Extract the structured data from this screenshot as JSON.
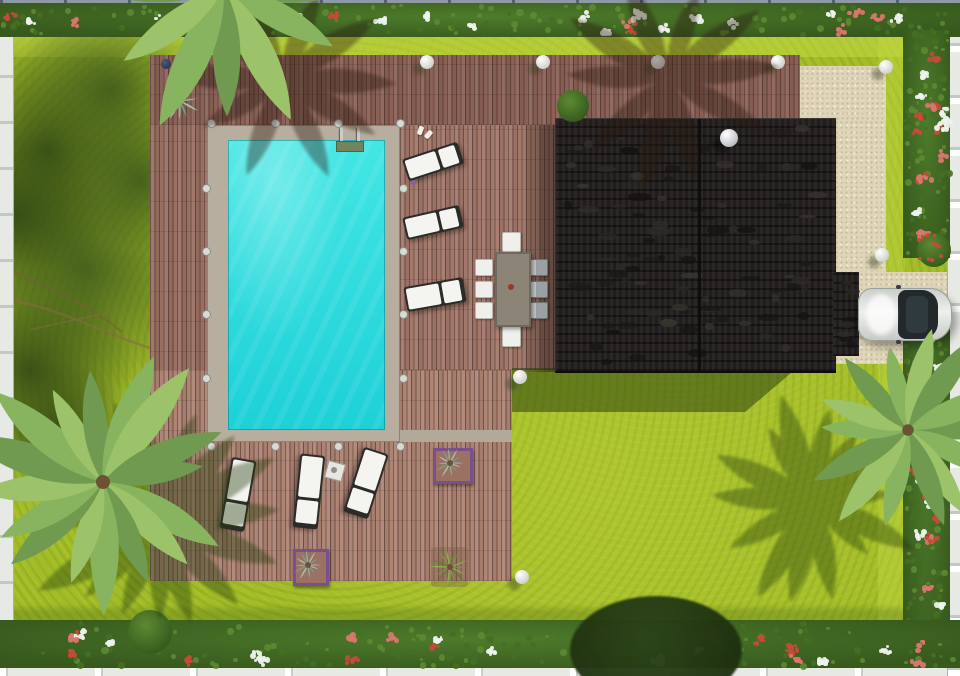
{
  "scene": {
    "description": "Photorealistic aerial top-down 3D render of a villa garden: L-shaped wooden pool deck with turquoise rectangular swimming pool and ladder, six white sun loungers, outdoor dining table with eight chairs, dark charcoal flat house roof with white dome skylight, gravel driveway with parked white car, bright lawn, three palm trees, flower hedges and white perimeter fences",
    "palette": {
      "lawn": "#a3bd28",
      "lawn-light": "#bdd63e",
      "lawn-dark": "#577619",
      "hedge": "#4d7b2b",
      "flower-red": "#c64a38",
      "flower-white": "#eef2ee",
      "flower-pink": "#d9766e",
      "leaf-1": "#5d8a33",
      "leaf-2": "#456f23",
      "deck-gap": "rgba(56,32,26,.5)",
      "pool-border": "#b7ae9f",
      "water1": "#44e6e4",
      "water2": "#1ed0d8",
      "roof": "#242120",
      "gravel": "#ded4b7",
      "white": "#f4f4f1",
      "frame": "#2b2b28",
      "table": "#8b8477",
      "chair-gray": "#9aa1a4",
      "red-dot": "#a23527",
      "car": "#e0e2df",
      "glass": "#23282b",
      "purple": "#7b4f8f",
      "sphere": "#f3f3ef",
      "fence-w": "#e7e9e5",
      "fence-g": "#8e99a4",
      "palm-1": "#6f9a4f",
      "palm-2": "#88b35f",
      "palm-3": "#9cc26a",
      "agave-1": "#8fb29c",
      "agave-2": "#a6c4ae",
      "agave-3": "#7ba089",
      "grass-1": "#6f9e36",
      "grass-2": "#86b84b",
      "grass-3": "#557f26"
    },
    "deck_rects": [
      {
        "x": 150,
        "y": 55,
        "w": 650,
        "h": 70,
        "c": "#8a6156"
      },
      {
        "x": 150,
        "y": 125,
        "w": 57,
        "h": 317,
        "c": "#996f62"
      },
      {
        "x": 400,
        "y": 125,
        "w": 155,
        "h": 245,
        "c": "#a2786a"
      },
      {
        "x": 150,
        "y": 370,
        "w": 362,
        "h": 211,
        "c": "#ae8474"
      }
    ],
    "gravel_rects": [
      {
        "x": 800,
        "y": 66,
        "w": 86,
        "h": 54
      },
      {
        "x": 834,
        "y": 120,
        "w": 52,
        "h": 155
      },
      {
        "x": 834,
        "y": 272,
        "w": 126,
        "h": 92
      }
    ],
    "driveway_edge_line": {
      "x": 858,
      "y": 336,
      "w": 102,
      "h": 3,
      "c": "#c7bc9f"
    },
    "pool": {
      "border": {
        "x": 207,
        "y": 125,
        "w": 193,
        "h": 317
      },
      "water": {
        "x": 228,
        "y": 140,
        "w": 157,
        "h": 290
      },
      "path_strip": {
        "x": 400,
        "y": 430,
        "w": 112,
        "h": 12
      },
      "ladder": {
        "rail1_x": 340,
        "rail2_x": 357,
        "rail_y": 127,
        "rail_h": 17,
        "mat": {
          "x": 336,
          "y": 141,
          "w": 26,
          "h": 9
        }
      }
    },
    "house": {
      "roof": {
        "x": 555,
        "y": 118,
        "w": 280,
        "h": 252
      },
      "garage": {
        "x": 833,
        "y": 272,
        "w": 26,
        "h": 84
      },
      "ridge_x": 697,
      "dome": {
        "cx": 729,
        "cy": 138,
        "r": 9
      }
    },
    "car": {
      "x": 858,
      "y": 288,
      "w": 94,
      "h": 53
    },
    "dining": {
      "table": {
        "x": 495,
        "y": 252,
        "w": 32,
        "h": 71
      },
      "centerpiece": {
        "cx": 511,
        "cy": 287,
        "r": 3
      },
      "chairs": [
        {
          "x": 475,
          "y": 259,
          "w": 16,
          "h": 15,
          "kind": "white"
        },
        {
          "x": 475,
          "y": 281,
          "w": 16,
          "h": 15,
          "kind": "white"
        },
        {
          "x": 475,
          "y": 302,
          "w": 16,
          "h": 15,
          "kind": "white"
        },
        {
          "x": 529,
          "y": 259,
          "w": 17,
          "h": 15,
          "kind": "gray"
        },
        {
          "x": 529,
          "y": 281,
          "w": 17,
          "h": 15,
          "kind": "gray"
        },
        {
          "x": 529,
          "y": 302,
          "w": 17,
          "h": 15,
          "kind": "gray"
        },
        {
          "x": 502,
          "y": 232,
          "w": 17,
          "h": 18,
          "kind": "white"
        },
        {
          "x": 502,
          "y": 325,
          "w": 17,
          "h": 20,
          "kind": "white"
        }
      ]
    },
    "loungers": [
      {
        "cx": 433,
        "cy": 161,
        "len": 58,
        "wid": 23,
        "rot": -18
      },
      {
        "cx": 433,
        "cy": 222,
        "len": 58,
        "wid": 23,
        "rot": -13
      },
      {
        "cx": 435,
        "cy": 294,
        "len": 60,
        "wid": 25,
        "rot": -10
      },
      {
        "cx": 238,
        "cy": 494,
        "len": 72,
        "wid": 25,
        "rot": 100
      },
      {
        "cx": 309,
        "cy": 491,
        "len": 74,
        "wid": 25,
        "rot": 96
      },
      {
        "cx": 366,
        "cy": 483,
        "len": 68,
        "wid": 26,
        "rot": 108
      }
    ],
    "side_table": {
      "x": 326,
      "y": 462,
      "w": 16,
      "h": 16,
      "rot": 15
    },
    "slippers": [
      {
        "x": 418,
        "y": 126,
        "rot": 20
      },
      {
        "x": 426,
        "y": 130,
        "rot": 40
      }
    ],
    "tiny_flower": {
      "x": 413,
      "y": 182
    },
    "planters": [
      {
        "x": 433,
        "y": 448,
        "w": 34,
        "h": 30,
        "purple": true,
        "plant": "agave"
      },
      {
        "x": 293,
        "y": 549,
        "w": 30,
        "h": 31,
        "purple": true,
        "plant": "agave"
      },
      {
        "x": 431,
        "y": 547,
        "w": 37,
        "h": 40,
        "purple": false,
        "plant": "grass"
      }
    ],
    "deck_agave": {
      "cx": 180,
      "cy": 101,
      "r": 21
    },
    "lamps": [
      {
        "x": 427,
        "y": 62
      },
      {
        "x": 543,
        "y": 62
      },
      {
        "x": 658,
        "y": 62
      },
      {
        "x": 778,
        "y": 62
      },
      {
        "x": 886,
        "y": 67
      },
      {
        "x": 882,
        "y": 255
      },
      {
        "x": 520,
        "y": 377
      },
      {
        "x": 522,
        "y": 577
      }
    ],
    "dark_lamp": {
      "x": 166,
      "y": 64
    },
    "deck_lights": [
      [
        210,
        122
      ],
      [
        274,
        122
      ],
      [
        337,
        122
      ],
      [
        399,
        122
      ],
      [
        402,
        187
      ],
      [
        402,
        250
      ],
      [
        402,
        313
      ],
      [
        402,
        377
      ],
      [
        205,
        187
      ],
      [
        205,
        250
      ],
      [
        205,
        313
      ],
      [
        205,
        377
      ],
      [
        210,
        445
      ],
      [
        274,
        445
      ],
      [
        337,
        445
      ],
      [
        399,
        445
      ]
    ],
    "hedges": [
      {
        "x": 0,
        "y": 3,
        "w": 960,
        "h": 34,
        "clusters": 26,
        "leaves": 130,
        "redw": 0.45
      },
      {
        "x": 903,
        "y": 30,
        "w": 47,
        "h": 228,
        "clusters": 16,
        "leaves": 80,
        "redw": 0.6
      },
      {
        "x": 903,
        "y": 308,
        "w": 47,
        "h": 360,
        "clusters": 20,
        "leaves": 100,
        "redw": 0.55
      },
      {
        "x": 0,
        "y": 620,
        "w": 960,
        "h": 48,
        "clusters": 28,
        "leaves": 140,
        "redw": 0.5
      }
    ],
    "fences": [
      {
        "x": 0,
        "y": 0,
        "w": 960,
        "h": 6,
        "kind": "gray-rail"
      },
      {
        "x": 0,
        "y": 4,
        "w": 13,
        "h": 672,
        "kind": "white-left"
      },
      {
        "x": 0,
        "y": 664,
        "w": 960,
        "h": 12,
        "kind": "white-bottom"
      },
      {
        "x": 947,
        "y": 30,
        "w": 13,
        "h": 646,
        "kind": "white-right"
      }
    ],
    "tree_blobs": [
      {
        "cx": 48,
        "cy": 150,
        "r": 120
      },
      {
        "cx": 85,
        "cy": 270,
        "r": 135
      },
      {
        "cx": 30,
        "cy": 370,
        "r": 105
      },
      {
        "cx": 110,
        "cy": 90,
        "r": 95
      },
      {
        "cx": 18,
        "cy": 215,
        "r": 85
      },
      {
        "cx": 140,
        "cy": 180,
        "r": 70
      },
      {
        "cx": 60,
        "cy": 430,
        "r": 70
      }
    ],
    "bushes": [
      {
        "cx": 573,
        "cy": 106,
        "r": 16,
        "type": "green"
      },
      {
        "cx": 934,
        "cy": 250,
        "r": 17,
        "type": "red"
      },
      {
        "cx": 150,
        "cy": 632,
        "r": 22,
        "type": "green"
      }
    ],
    "dark_tree": {
      "x": 570,
      "y": 596,
      "w": 172,
      "h": 108
    },
    "palms": [
      {
        "cx": 103,
        "cy": 482,
        "r": 140,
        "n": 16,
        "seed": 7,
        "sdx": 55,
        "sdy": 42
      },
      {
        "cx": 908,
        "cy": 430,
        "r": 115,
        "n": 14,
        "seed": 11,
        "sdx": -95,
        "sdy": 70
      },
      {
        "cx": 224,
        "cy": -12,
        "r": 170,
        "n": 12,
        "seed": 3,
        "sdx": 0,
        "sdy": 0
      }
    ],
    "deck_palm_shadows": [
      {
        "cx": 282,
        "cy": 80,
        "r": 118,
        "n": 10,
        "seed": 5
      },
      {
        "cx": 668,
        "cy": 78,
        "r": 112,
        "n": 10,
        "seed": 9
      }
    ],
    "house_shadow_poly": "512px 368px, 797px 368px, 745px 412px, 512px 412px"
  }
}
